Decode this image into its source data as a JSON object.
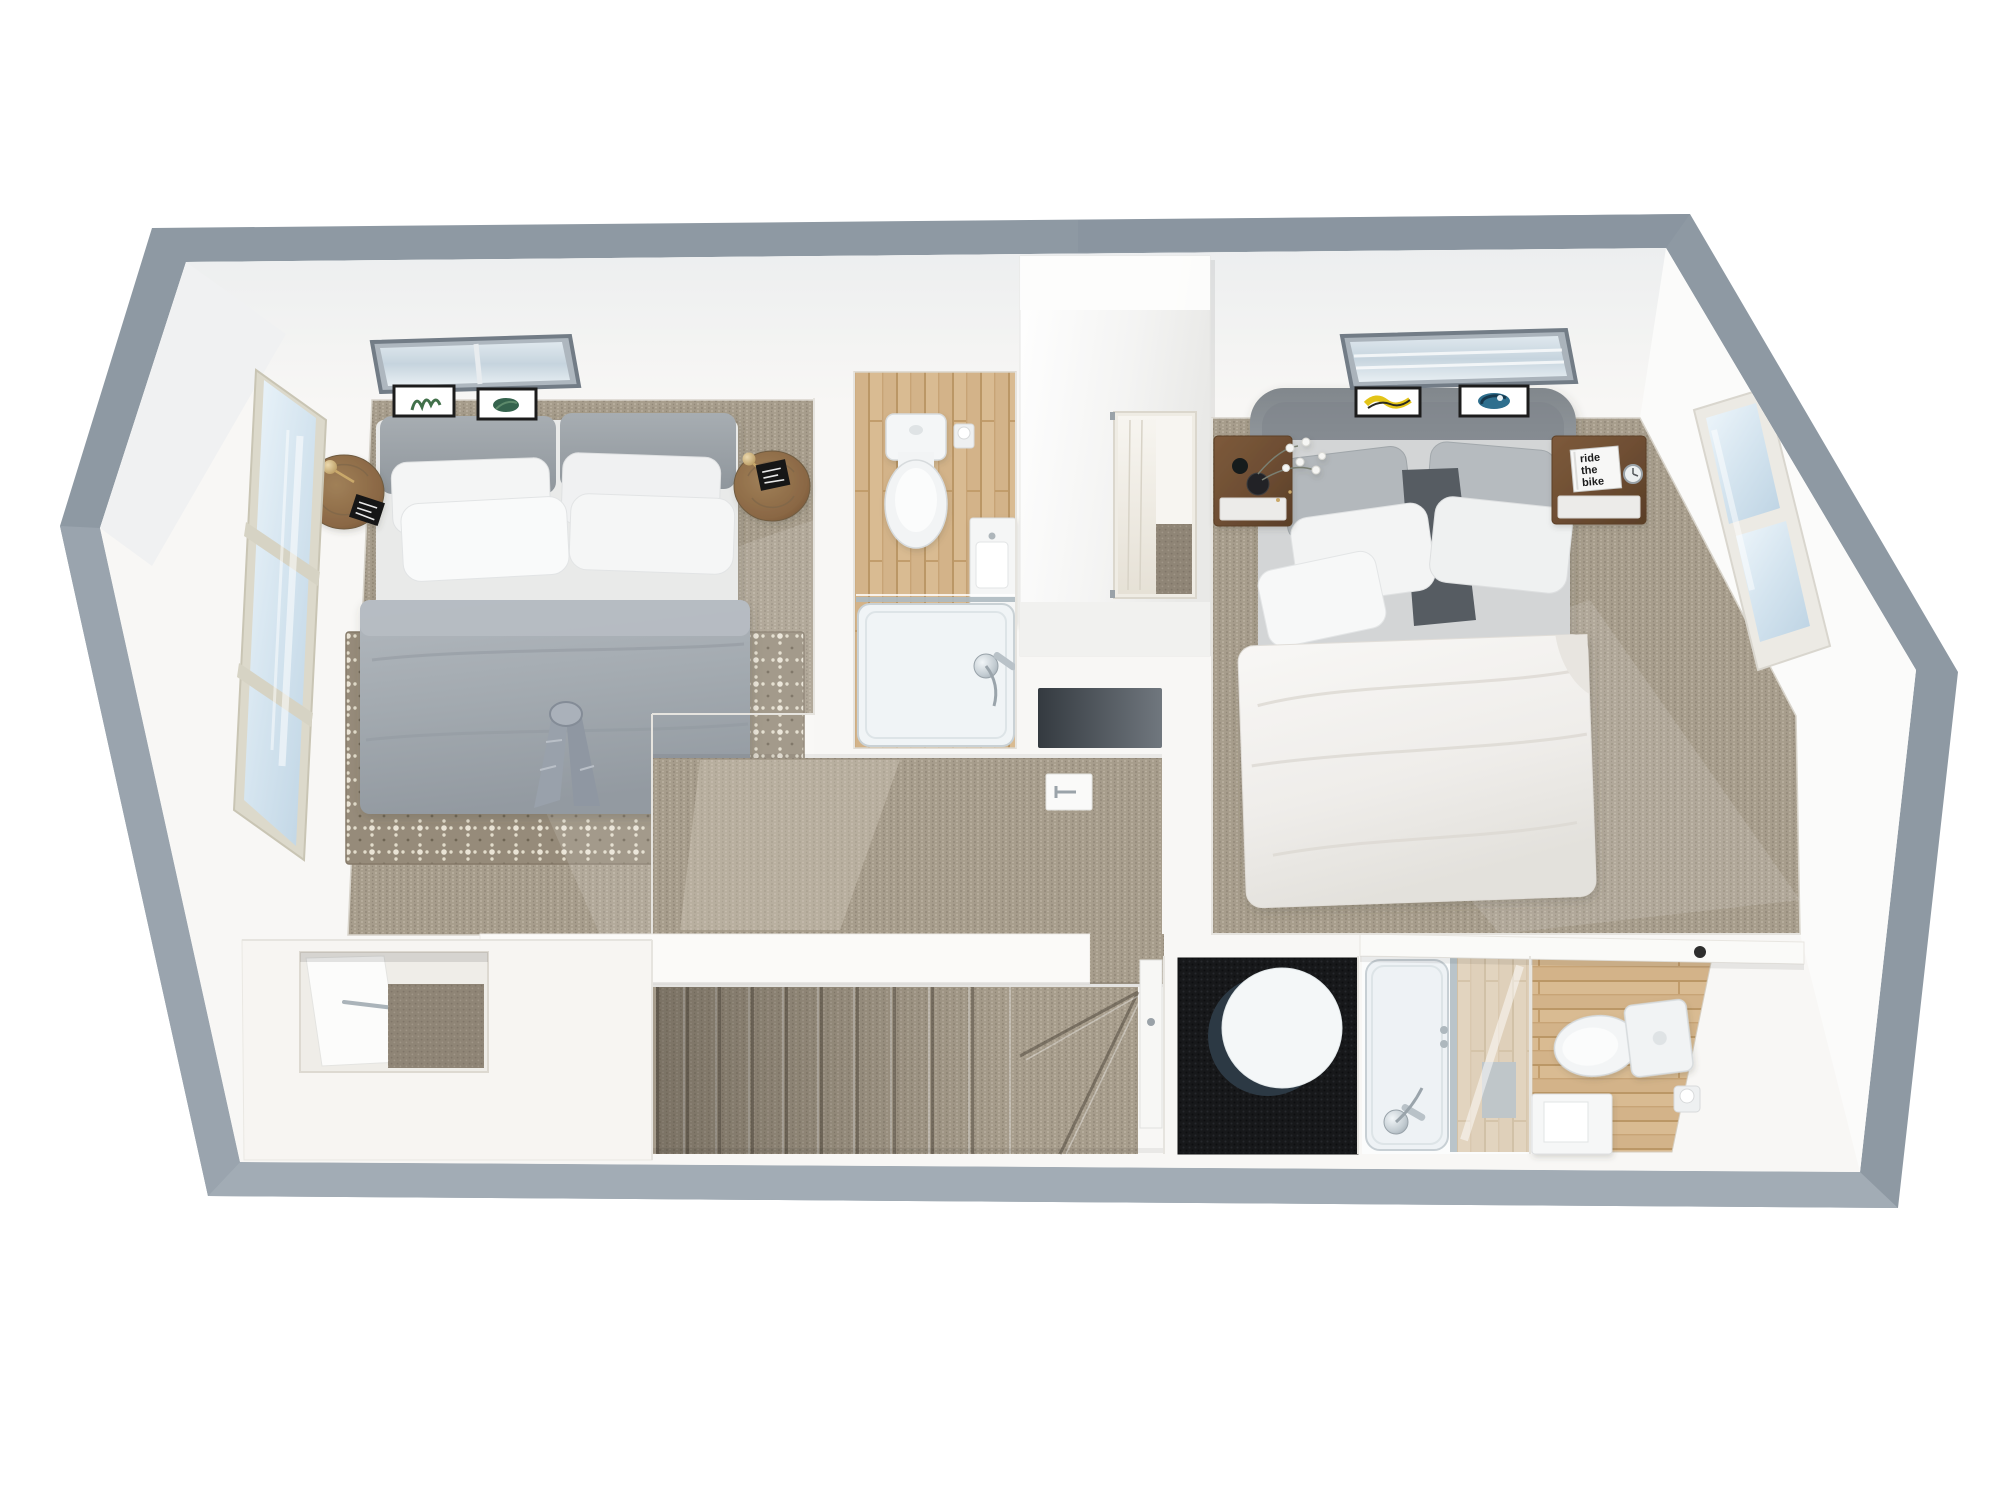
{
  "scene": {
    "type": "3d-floor-plan-render",
    "view": "top-down dollhouse view of an upper floor, white background",
    "wall_cap_color": "#8e99a3"
  },
  "palette": {
    "background": "#ffffff",
    "wall_band": "#8e99a3",
    "interior_white": "#f8f7f5",
    "carpet": "#a79d8c",
    "carpet_dark": "#8f8576",
    "rug_base": "#968b7a",
    "rug_motif": "#eae4d6",
    "wood_floor": "#d9bb92",
    "bed_grey": "#a0a6ab",
    "linen_white": "#f3f4f4",
    "duvet_white": "#f1efec",
    "headboard_grey": "#8d9398",
    "walnut": "#6e4e33",
    "oak_round": "#8a6744",
    "glass_blue": "#d4e4ef",
    "skylight_frame": "#78828c",
    "dark_floor": "#17181a",
    "chrome": "#b9c2c8",
    "brass": "#c9a86a",
    "art_yellow": "#e3c418",
    "art_teal": "#2e6f8e",
    "plant_green": "#41704a"
  },
  "right_bedroom": {
    "book": {
      "line1": "ride",
      "line2": "the",
      "line3": "bike"
    }
  },
  "rooms": [
    {
      "name": "bedroom-left",
      "floor": "grey loop-pile carpet",
      "features": [
        "double bed with grey duvet and bow",
        "diamond-pattern rug",
        "two round oak side tables with brass lamps",
        "skylight",
        "two botanical prints",
        "tall gable window"
      ]
    },
    {
      "name": "ensuite-bathroom",
      "floor": "oak planks",
      "features": [
        "toilet",
        "toilet-roll holder",
        "wall basin",
        "shower tray with glass screen",
        "chrome mixer"
      ]
    },
    {
      "name": "walk-in-wardrobe",
      "floor": "carpet",
      "features": [
        "white cabinet volume",
        "open doorway",
        "mirror panel"
      ]
    },
    {
      "name": "bedroom-right",
      "floor": "grey loop-pile carpet",
      "features": [
        "upholstered double bed",
        "white duvet",
        "two walnut nightstands",
        "black vases with white flowers",
        "book",
        "alarm clock",
        "skylight",
        "two abstract prints",
        "tall window"
      ]
    },
    {
      "name": "landing-hallway",
      "floor": "carpet",
      "features": [
        "open door leaf"
      ]
    },
    {
      "name": "staircase",
      "floor": "carpet",
      "features": [
        "straight flight",
        "winder steps"
      ]
    },
    {
      "name": "store-room",
      "floor": "pale boards",
      "features": [
        "open door",
        "carpeted closet"
      ]
    },
    {
      "name": "dressing-room",
      "floor": "black carpet",
      "features": [
        "round white table"
      ]
    },
    {
      "name": "shower-room",
      "features": [
        "walk-in shower tray",
        "glass screen",
        "chrome shower set"
      ]
    },
    {
      "name": "bathroom-right",
      "floor": "oak planks",
      "features": [
        "toilet",
        "toilet-roll holder",
        "vanity unit",
        "counter shelf"
      ]
    }
  ]
}
